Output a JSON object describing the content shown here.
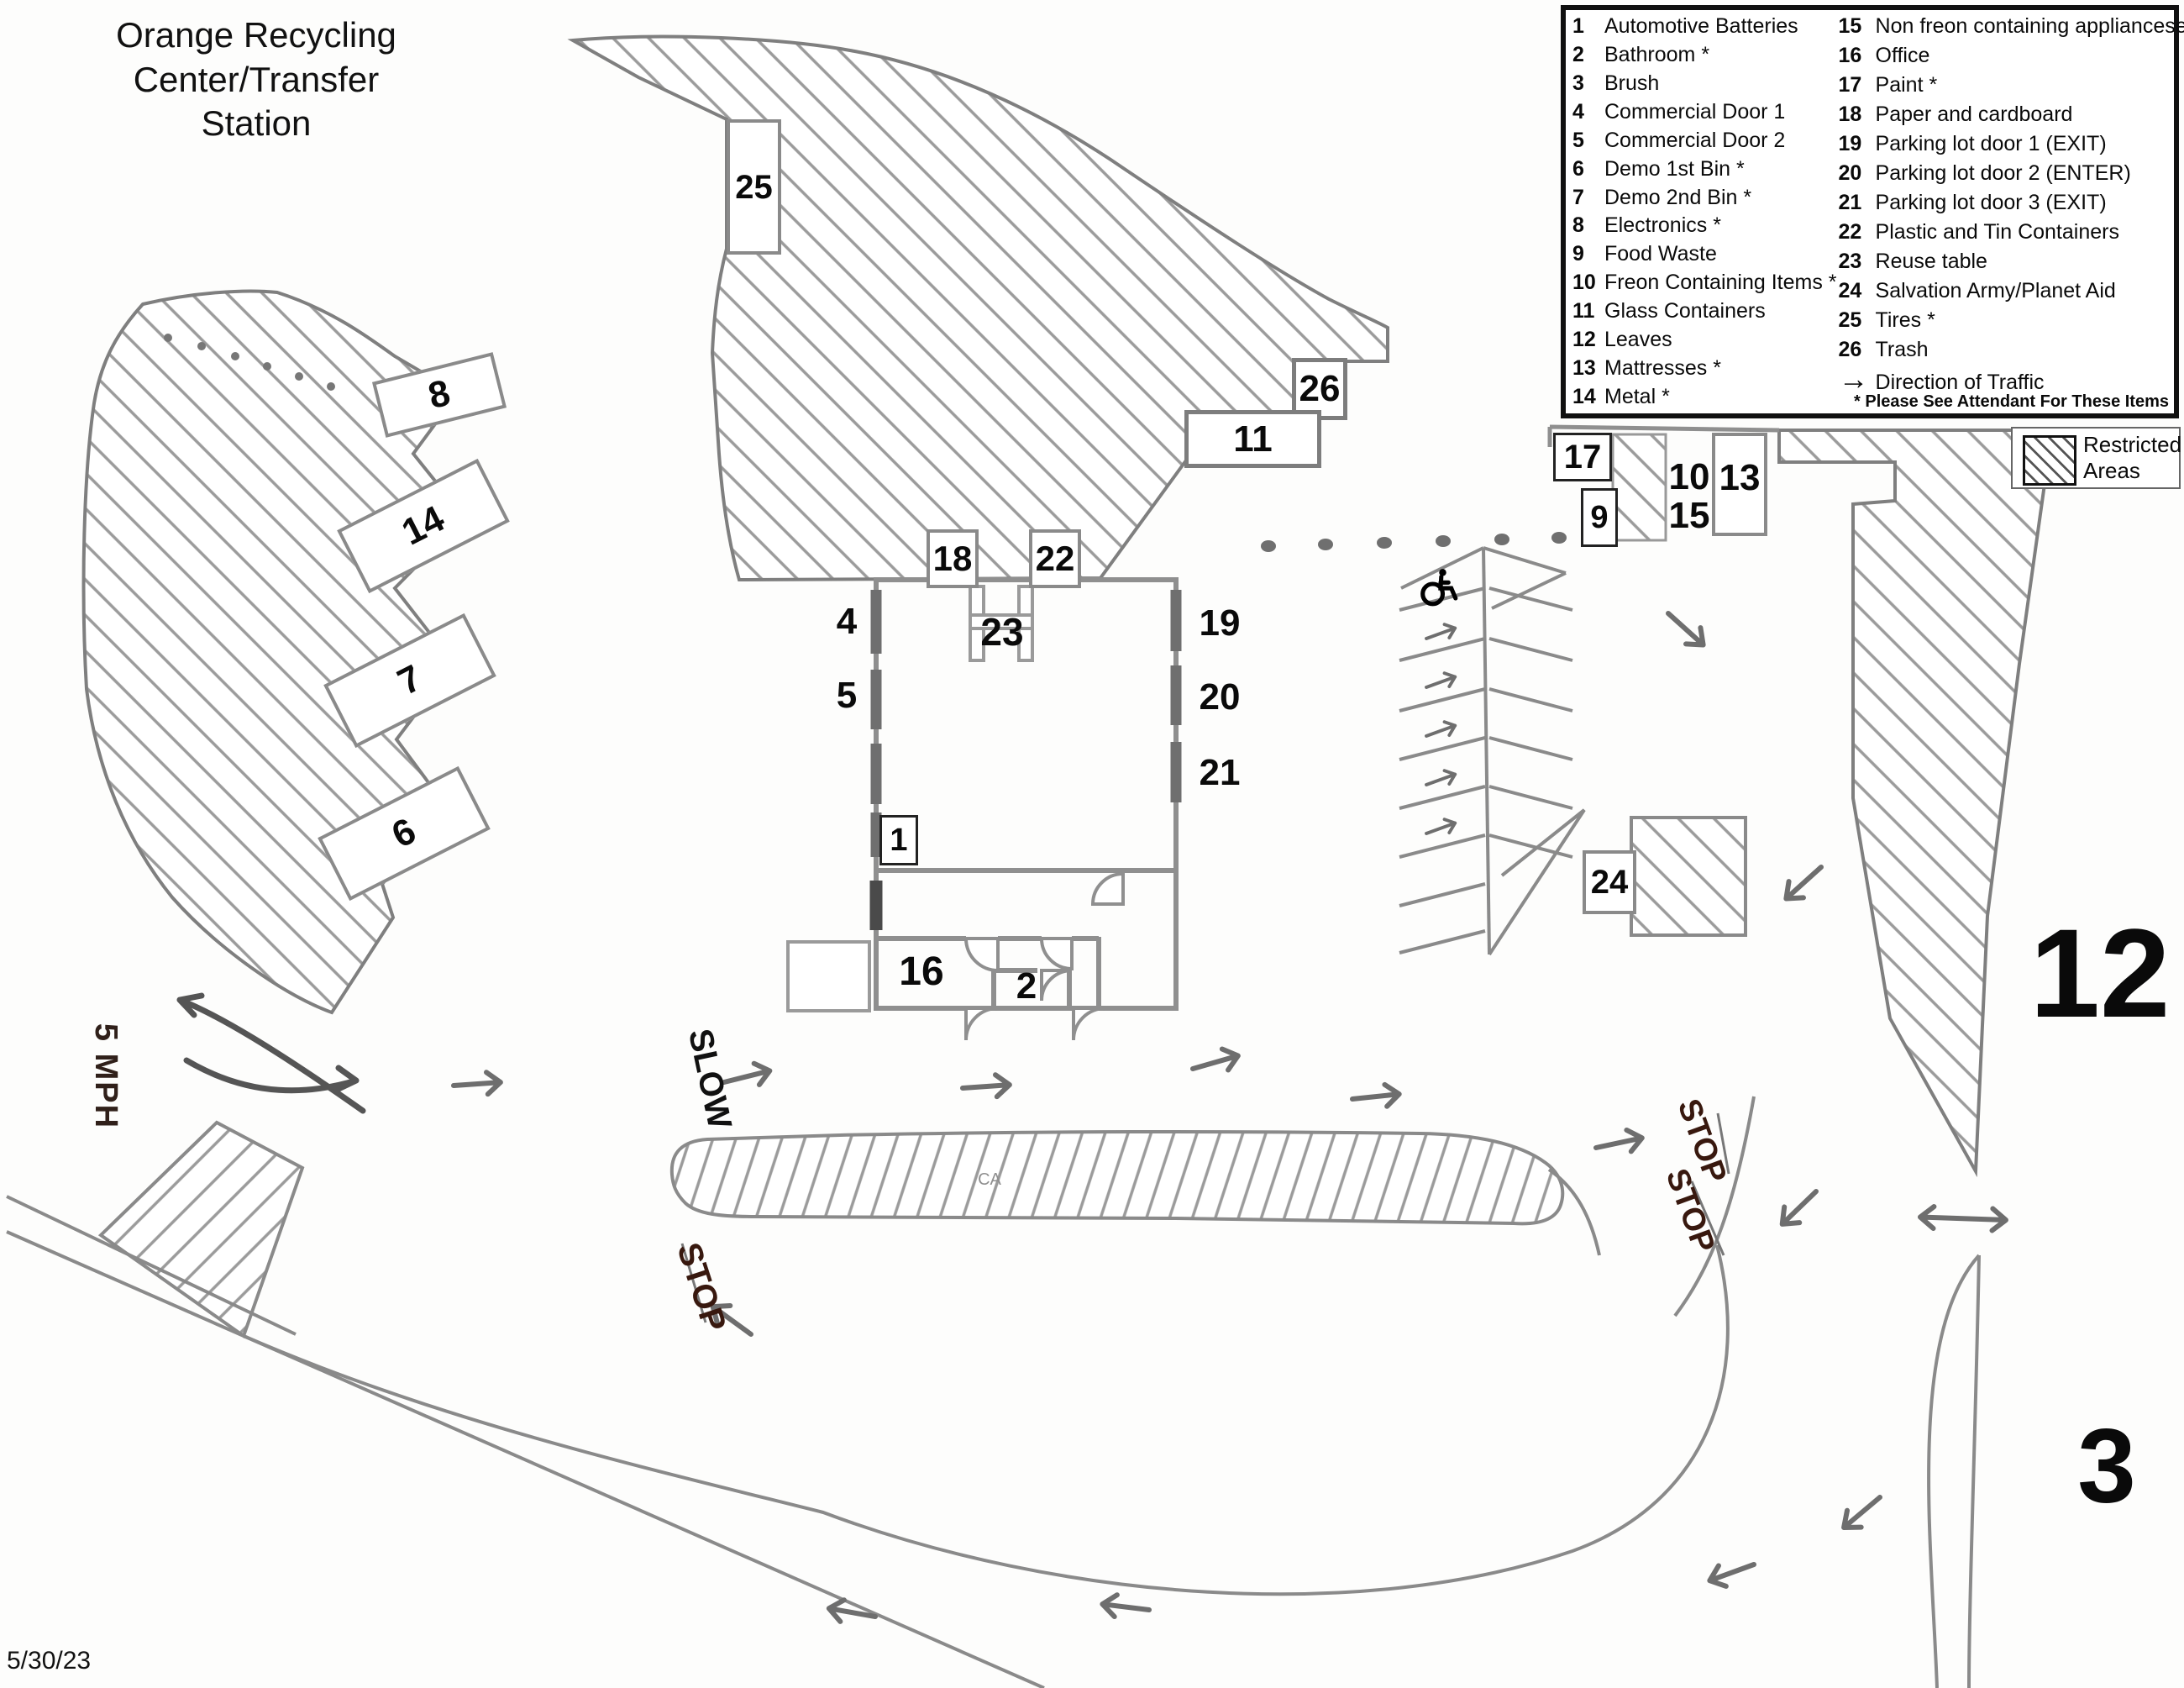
{
  "title": {
    "line1": "Orange Recycling",
    "line2": "Center/Transfer Station"
  },
  "date": "5/30/23",
  "legend": {
    "left": [
      {
        "num": "1",
        "label": "Automotive Batteries"
      },
      {
        "num": "2",
        "label": "Bathroom *"
      },
      {
        "num": "3",
        "label": "Brush"
      },
      {
        "num": "4",
        "label": "Commercial Door 1"
      },
      {
        "num": "5",
        "label": "Commercial Door 2"
      },
      {
        "num": "6",
        "label": "Demo 1st Bin *"
      },
      {
        "num": "7",
        "label": "Demo 2nd Bin *"
      },
      {
        "num": "8",
        "label": "Electronics *"
      },
      {
        "num": "9",
        "label": "Food Waste"
      },
      {
        "num": "10",
        "label": "Freon Containing Items *"
      },
      {
        "num": "11",
        "label": "Glass Containers"
      },
      {
        "num": "12",
        "label": "Leaves"
      },
      {
        "num": "13",
        "label": "Mattresses *"
      },
      {
        "num": "14",
        "label": "Metal *"
      }
    ],
    "right": [
      {
        "num": "15",
        "label": "Non freon containing appliancese *"
      },
      {
        "num": "16",
        "label": "Office"
      },
      {
        "num": "17",
        "label": "Paint *"
      },
      {
        "num": "18",
        "label": "Paper and cardboard"
      },
      {
        "num": "19",
        "label": "Parking lot door 1 (EXIT)"
      },
      {
        "num": "20",
        "label": "Parking lot door 2 (ENTER)"
      },
      {
        "num": "21",
        "label": "Parking lot door 3 (EXIT)"
      },
      {
        "num": "22",
        "label": "Plastic and Tin Containers"
      },
      {
        "num": "23",
        "label": "Reuse table"
      },
      {
        "num": "24",
        "label": "Salvation Army/Planet Aid"
      },
      {
        "num": "25",
        "label": "Tires *"
      },
      {
        "num": "26",
        "label": "Trash"
      }
    ],
    "direction": {
      "arrow": "→",
      "label": "Direction of Traffic"
    },
    "footnote": "* Please See Attendant For These Items"
  },
  "restricted": {
    "label": "Restricted Areas"
  },
  "map": {
    "labels": {
      "automotive_batteries": "1",
      "bathroom": "2",
      "brush": "3",
      "commercial_door_1": "4",
      "commercial_door_2": "5",
      "demo_1st_bin": "6",
      "demo_2nd_bin": "7",
      "electronics": "8",
      "food_waste": "9",
      "freon_items": "10",
      "glass_containers": "11",
      "leaves": "12",
      "mattresses": "13",
      "metal": "14",
      "non_freon_appliances": "15",
      "office": "16",
      "paint": "17",
      "paper_cardboard": "18",
      "parking_door_1": "19",
      "parking_door_2": "20",
      "parking_door_3": "21",
      "plastic_tin": "22",
      "reuse_table": "23",
      "salvation_army": "24",
      "tires": "25",
      "trash": "26"
    },
    "road_text": {
      "speed_limit": "5 MPH",
      "slow": "SLOW",
      "stop_entry": "STOP",
      "stop_exit_1": "STOP",
      "stop_exit_2": "STOP",
      "ca": "CA"
    }
  }
}
